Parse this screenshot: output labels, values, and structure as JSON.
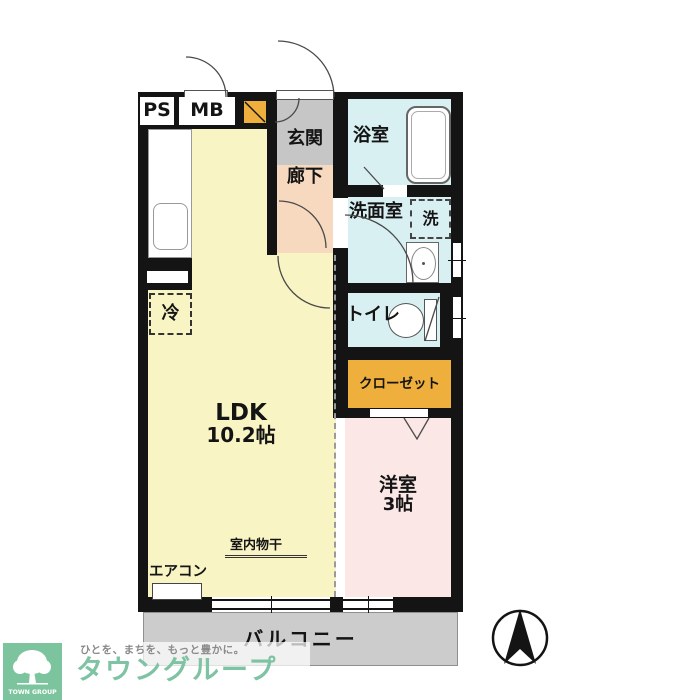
{
  "rooms": {
    "ldk": {
      "label": "LDK",
      "size": "10.2帖"
    },
    "western_room": {
      "label": "洋室",
      "size": "3帖"
    },
    "entrance": "玄関",
    "hallway": "廊下",
    "bathroom": "浴室",
    "washroom": "洗面室",
    "laundry": "洗",
    "toilet": "トイレ",
    "closet": "クローゼット",
    "balcony": "バルコニー"
  },
  "labels": {
    "pipe_space": "PS",
    "meter_box": "MB",
    "refrigerator": "冷",
    "aircon": "エアコン",
    "indoor_drying": "室内物干"
  },
  "branding": {
    "logo_text": "TOWN GROUP",
    "tagline": "ひとを、まちを、もっと豊かに。",
    "brand_name": "タウングループ"
  },
  "colors": {
    "ldk_bg": "#F8F4C3",
    "entrance_bg": "#C6C6C6",
    "hallway_bg": "#F7D9C0",
    "wet_area_bg": "#D9F0F2",
    "closet_bg": "#EFAF3C",
    "western_room_bg": "#FAE7E6",
    "balcony_bg": "#CCCCCC",
    "wall": "#141414",
    "brand_green": "#7EC3A3"
  },
  "compass": {
    "points": "north"
  }
}
